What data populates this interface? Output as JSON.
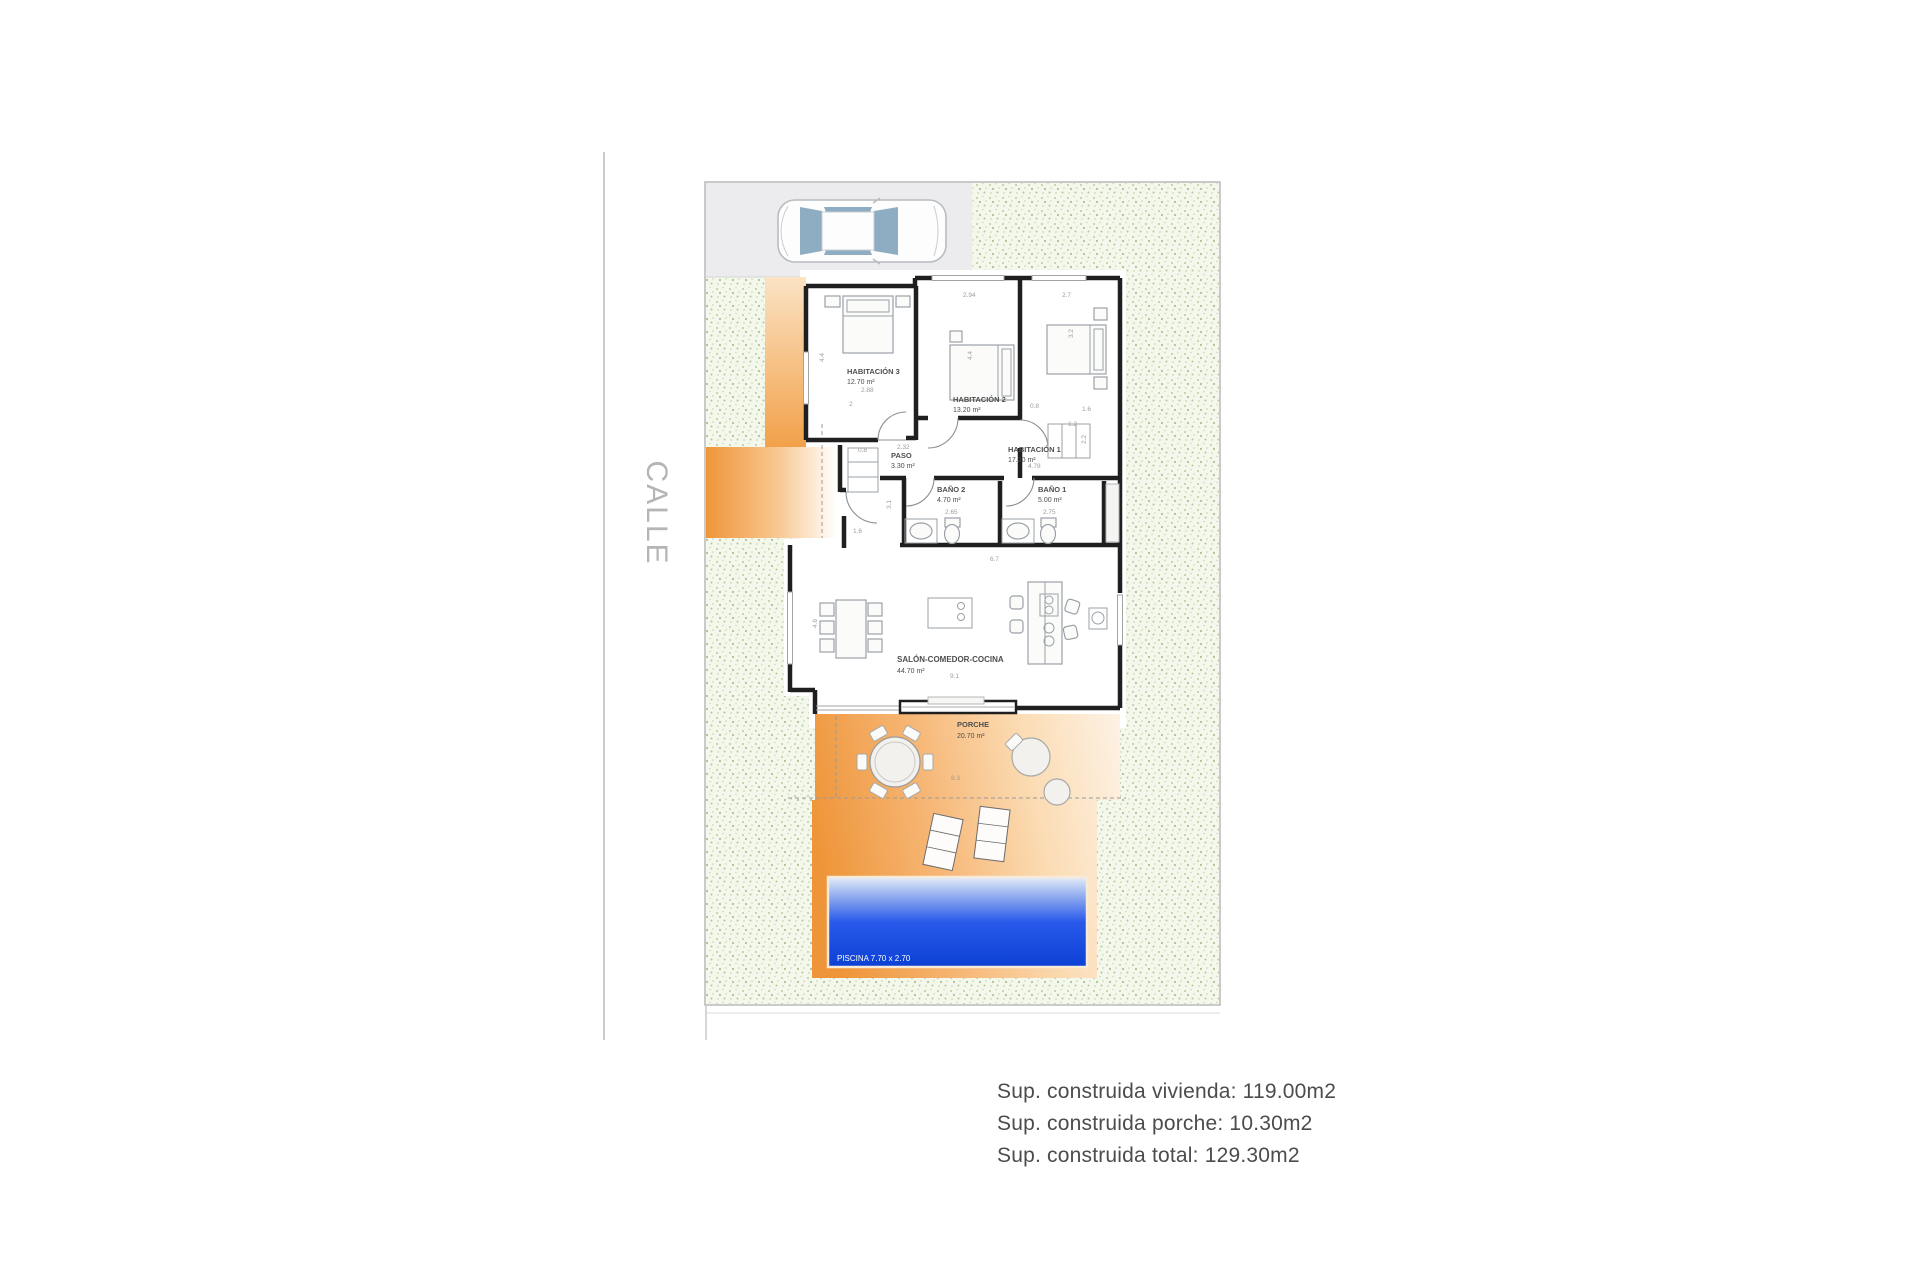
{
  "street": {
    "label": "CALLE"
  },
  "rooms": [
    {
      "id": "hab3",
      "name": "HABITACIÓN 3",
      "area": "12.70 m²"
    },
    {
      "id": "hab2",
      "name": "HABITACIÓN 2",
      "area": "13.20 m²"
    },
    {
      "id": "hab1",
      "name": "HABITACIÓN 1",
      "area": "17.20 m²"
    },
    {
      "id": "paso",
      "name": "PASO",
      "area": "3.30 m²"
    },
    {
      "id": "bano2",
      "name": "BAÑO 2",
      "area": "4.70 m²"
    },
    {
      "id": "bano1",
      "name": "BAÑO 1",
      "area": "5.00 m²"
    },
    {
      "id": "salon",
      "name": "SALÓN-COMEDOR-COCINA",
      "area": "44.70 m²"
    },
    {
      "id": "porche",
      "name": "PORCHE",
      "area": "20.70 m²"
    }
  ],
  "pool": {
    "label": "PISCINA 7.70 x 2.70"
  },
  "dims": [
    "2.94",
    "2.7",
    "4.4",
    "3.2",
    "2.88",
    "2",
    "0.8",
    "2.32",
    "0.8",
    "1.2",
    "2.2",
    "1.6",
    "3.1",
    "1.6",
    "2.65",
    "2.75",
    "4.78",
    "4.6",
    "4.4",
    "9.1",
    "6.7",
    "8.3"
  ],
  "summary": {
    "vivienda": "Sup. construida vivienda: 119.00m2",
    "porche": "Sup. construida porche: 10.30m2",
    "total": "Sup. construida total: 129.30m2"
  },
  "colors": {
    "wall": "#1f1f1f",
    "path_orange": "#ef9539",
    "pool_blue": "#0c40d4",
    "garden_speckle": "#b2c79a",
    "street_text": "#b5b5b5"
  }
}
